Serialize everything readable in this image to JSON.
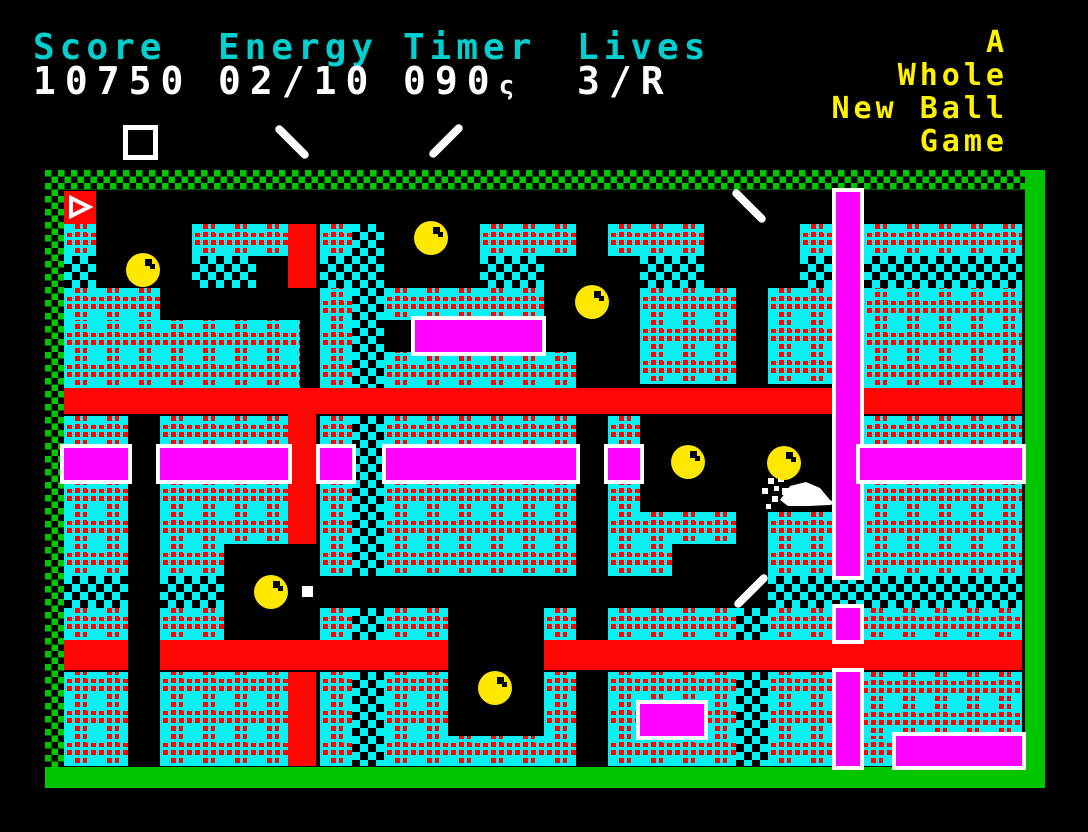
{
  "colors": {
    "wall_cyan": "#00F2F2",
    "path_red": "#FF0505",
    "bar_magenta": "#FF00FF",
    "border_green": "#00C600",
    "hud_label_cyan": "#00CFCF",
    "hud_value_white": "#FFFFFF",
    "title_yellow": "#FFF200",
    "ball_yellow": "#FFE800",
    "sprite_white": "#FFFFFF"
  },
  "hud": {
    "fields": [
      {
        "label": "Score",
        "value": "10750",
        "suffix": "",
        "x": 33
      },
      {
        "label": "Energy",
        "value": "02/10",
        "suffix": "",
        "x": 218
      },
      {
        "label": "Timer",
        "value": "090",
        "suffix": "ς",
        "x": 403
      },
      {
        "label": "Lives",
        "value": "3/R",
        "suffix": "",
        "x": 577
      }
    ],
    "title_lines": [
      "A",
      "Whole",
      "New Ball",
      "Game"
    ]
  },
  "maze": {
    "plaid_walls": [
      [
        64,
        224,
        32,
        32
      ],
      [
        192,
        224,
        96,
        32
      ],
      [
        320,
        224,
        32,
        32
      ],
      [
        480,
        224,
        96,
        32
      ],
      [
        608,
        224,
        96,
        32
      ],
      [
        800,
        224,
        36,
        32
      ],
      [
        864,
        224,
        158,
        32
      ],
      [
        64,
        288,
        96,
        32
      ],
      [
        64,
        320,
        236,
        68
      ],
      [
        320,
        288,
        32,
        100
      ],
      [
        384,
        288,
        160,
        32
      ],
      [
        384,
        352,
        192,
        36
      ],
      [
        640,
        288,
        96,
        96
      ],
      [
        768,
        288,
        68,
        96
      ],
      [
        864,
        288,
        158,
        100
      ],
      [
        64,
        416,
        64,
        32
      ],
      [
        160,
        416,
        128,
        32
      ],
      [
        320,
        416,
        32,
        32
      ],
      [
        384,
        416,
        192,
        32
      ],
      [
        608,
        416,
        32,
        32
      ],
      [
        864,
        416,
        158,
        32
      ],
      [
        64,
        480,
        64,
        96
      ],
      [
        160,
        480,
        64,
        96
      ],
      [
        224,
        480,
        64,
        64
      ],
      [
        320,
        480,
        32,
        96
      ],
      [
        384,
        480,
        192,
        96
      ],
      [
        608,
        480,
        32,
        96
      ],
      [
        640,
        512,
        96,
        32
      ],
      [
        640,
        544,
        32,
        32
      ],
      [
        768,
        512,
        68,
        64
      ],
      [
        864,
        480,
        158,
        96
      ],
      [
        64,
        608,
        64,
        32
      ],
      [
        160,
        608,
        64,
        32
      ],
      [
        320,
        608,
        32,
        32
      ],
      [
        384,
        608,
        64,
        32
      ],
      [
        544,
        608,
        32,
        32
      ],
      [
        608,
        608,
        128,
        32
      ],
      [
        768,
        608,
        68,
        32
      ],
      [
        860,
        608,
        162,
        32
      ],
      [
        64,
        672,
        64,
        94
      ],
      [
        160,
        672,
        128,
        94
      ],
      [
        320,
        672,
        32,
        94
      ],
      [
        384,
        672,
        64,
        94
      ],
      [
        448,
        736,
        96,
        30
      ],
      [
        544,
        672,
        32,
        94
      ],
      [
        608,
        672,
        128,
        94
      ],
      [
        768,
        672,
        68,
        94
      ],
      [
        860,
        672,
        162,
        64
      ],
      [
        860,
        736,
        36,
        30
      ]
    ],
    "checker_walls": [
      [
        64,
        256,
        32,
        32
      ],
      [
        192,
        256,
        64,
        32
      ],
      [
        320,
        256,
        32,
        32
      ],
      [
        352,
        224,
        32,
        164
      ],
      [
        480,
        256,
        64,
        32
      ],
      [
        640,
        256,
        64,
        32
      ],
      [
        800,
        256,
        36,
        32
      ],
      [
        864,
        256,
        158,
        32
      ],
      [
        352,
        416,
        32,
        160
      ],
      [
        64,
        576,
        64,
        32
      ],
      [
        160,
        576,
        64,
        32
      ],
      [
        352,
        608,
        32,
        32
      ],
      [
        768,
        576,
        254,
        32
      ],
      [
        736,
        608,
        32,
        32
      ],
      [
        352,
        672,
        32,
        94
      ],
      [
        736,
        672,
        32,
        94
      ]
    ],
    "red_paths": [
      [
        288,
        224,
        28,
        64
      ],
      [
        64,
        388,
        772,
        26
      ],
      [
        860,
        388,
        162,
        26
      ],
      [
        288,
        414,
        28,
        130
      ],
      [
        64,
        640,
        64,
        30
      ],
      [
        160,
        640,
        288,
        30
      ],
      [
        544,
        640,
        478,
        30
      ],
      [
        288,
        672,
        28,
        94
      ]
    ],
    "magenta_bars": [
      [
        64,
        448,
        64,
        32
      ],
      [
        160,
        448,
        128,
        32
      ],
      [
        320,
        448,
        32,
        32
      ],
      [
        386,
        448,
        190,
        32
      ],
      [
        608,
        448,
        32,
        32
      ],
      [
        836,
        192,
        24,
        384
      ],
      [
        860,
        448,
        162,
        32
      ],
      [
        836,
        608,
        24,
        32
      ],
      [
        836,
        672,
        24,
        94
      ],
      [
        640,
        704,
        64,
        32
      ],
      [
        896,
        736,
        126,
        30
      ],
      [
        415,
        320,
        127,
        32
      ]
    ]
  },
  "sprites": {
    "balls": [
      [
        143,
        270
      ],
      [
        431,
        238
      ],
      [
        592,
        302
      ],
      [
        688,
        462
      ],
      [
        784,
        463
      ],
      [
        271,
        592
      ],
      [
        495,
        688
      ]
    ],
    "spinners": [
      {
        "x": 292,
        "y": 142,
        "angle": 45
      },
      {
        "x": 446,
        "y": 141,
        "angle": -45
      },
      {
        "x": 749,
        "y": 206,
        "angle": 45
      },
      {
        "x": 751,
        "y": 591,
        "angle": -45
      }
    ],
    "hud_square": {
      "x": 123,
      "y": 125,
      "size": 35
    },
    "white_dot": {
      "x": 302,
      "y": 586,
      "size": 11
    },
    "flag": {
      "x": 64,
      "y": 191,
      "w": 32,
      "h": 33
    },
    "player": {
      "x": 760,
      "y": 474,
      "w": 80,
      "h": 40
    }
  }
}
